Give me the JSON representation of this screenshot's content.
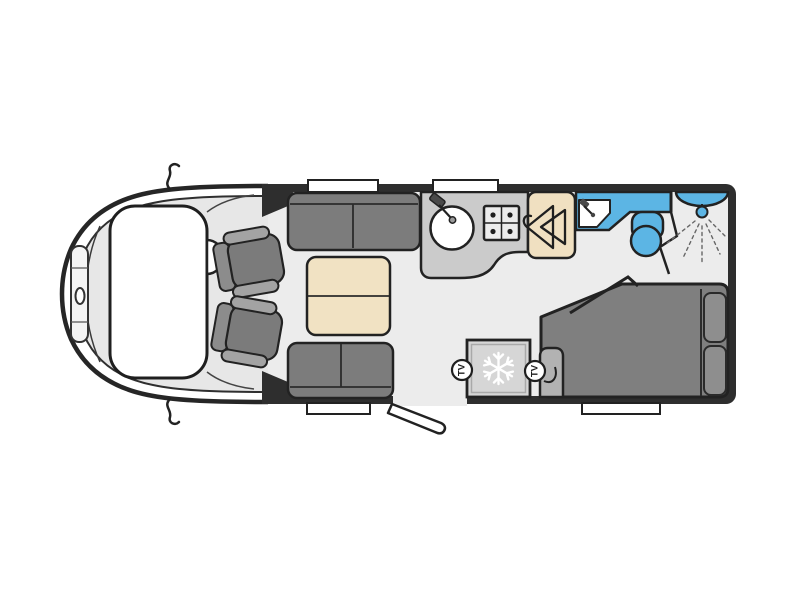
{
  "image": {
    "type": "floorplan",
    "subject": "motorhome-interior-top-view",
    "background": "#ffffff"
  },
  "labels": {
    "tv_points": [
      {
        "label": "TV"
      },
      {
        "label": "TV"
      }
    ]
  },
  "colors": {
    "wall": "#2e2e2e",
    "floor": "#ececec",
    "cab_body": "#ffffff",
    "cab_trim": "#e7e7e7",
    "window": "#ffffff",
    "sofa": "#7c7c7c",
    "seat_cushion": "#7b7b7b",
    "seat_back": "#8c8c8c",
    "seat_armrest": "#a3a3a3",
    "table": "#f1e2c3",
    "counter": "#cbcbcb",
    "hob": "#ececec",
    "wardrobe": "#f0e0c1",
    "water_fixture": "#5cb5e4",
    "bed": "#7f7f7f",
    "pillow": "#8e8e8e",
    "fridge": "#d6d6d6",
    "tv_cabinet": "#b2b2b2",
    "snowflake": "#ffffff",
    "outline": "#222222"
  },
  "rooms": [
    {
      "name": "cab"
    },
    {
      "name": "front-lounge"
    },
    {
      "name": "kitchen"
    },
    {
      "name": "washroom"
    },
    {
      "name": "rear-bedroom"
    }
  ],
  "fixtures": [
    "swivel-cab-seats",
    "parallel-sofas",
    "lounge-table",
    "kitchen-sink",
    "four-burner-hob",
    "wardrobe-with-hangers",
    "fridge-freezer",
    "tv-points",
    "washbasin",
    "toilet",
    "shower",
    "french-bed-with-pillows",
    "entry-door-open",
    "windows"
  ]
}
